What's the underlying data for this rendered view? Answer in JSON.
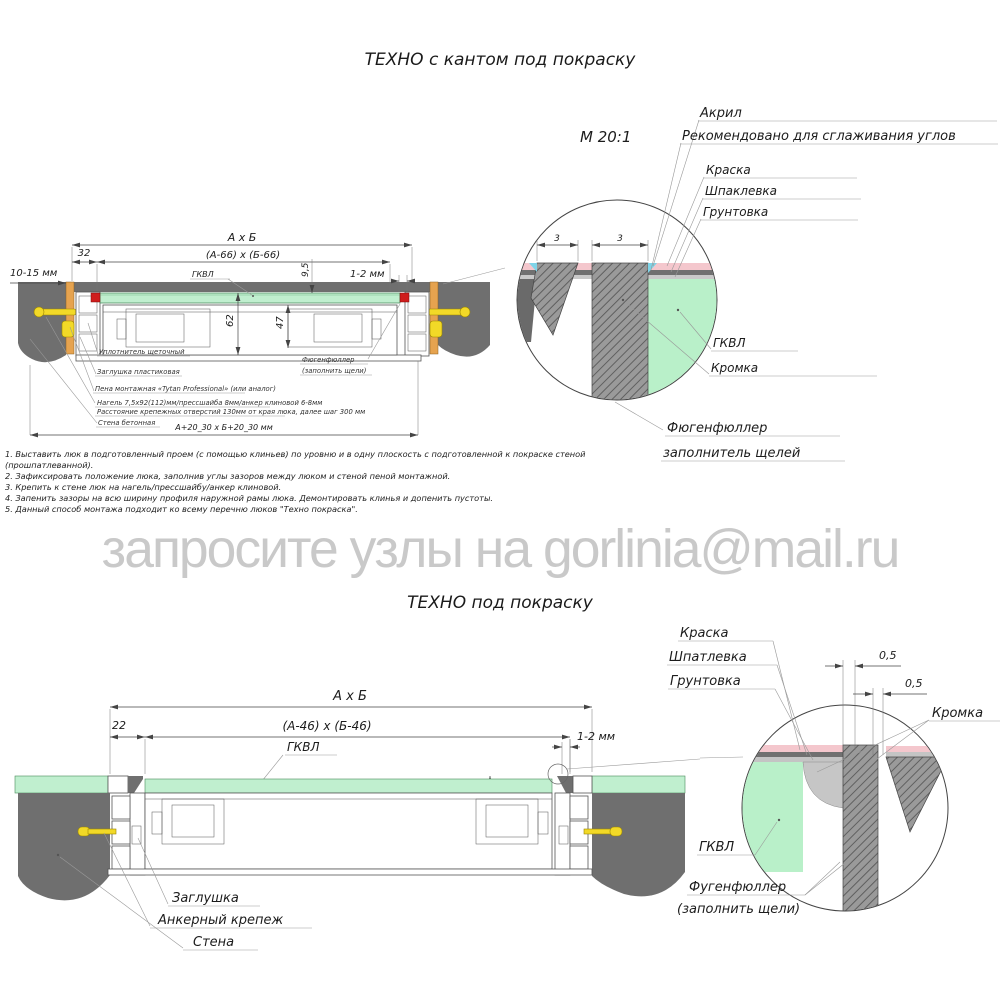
{
  "titles": {
    "top": "ТЕХНО с кантом под покраску",
    "bottom": "ТЕХНО под покраску"
  },
  "watermark": "запросите узлы на gorlinia@mail.ru",
  "notes": [
    "1. Выставить люк в подготовленный проем (с помощью клиньев) по уровню и в одну плоскость с подготовленной к покраске стеной (прошпатлеванной).",
    "2. Зафиксировать положение люка, заполнив углы зазоров между люком и стеной пеной монтажной.",
    "3. Крепить к стене люк на нагель/прессшайбу/анкер клиновой.",
    "4. Запенить зазоры на всю ширину профиля наружной рамы люка. Демонтировать клинья и допенить пустоты.",
    "5. Данный способ монтажа подходит ко всему перечню люков \"Техно покраска\"."
  ],
  "d1": {
    "dim_overall": "А х Б",
    "dim_inner": "(А-66) х (Б-66)",
    "dim_32": "32",
    "dim_gap_wall": "10-15 мм",
    "gkvl": "ГКВЛ",
    "dim_95": "9,5",
    "dim_12": "1-2 мм",
    "dim_62": "62",
    "dim_47": "47",
    "dim_opening": "А+20_30 х Б+20_30 мм",
    "lbl_seal": "Уплотнитель щеточный",
    "lbl_plug": "Заглушка пластиковая",
    "lbl_foam": "Пена монтажная «Tytan Professional» (или аналог)",
    "lbl_dowel": "Нагель 7,5х92(112)мм/прессшайба 8мм/анкер клиновой 6-8мм",
    "lbl_spacing": "Расстояние крепежных отверстий 130мм от края люка, далее шаг 300 мм",
    "lbl_wall": "Стена бетонная",
    "lbl_filler1": "Фюгенфюллер",
    "lbl_filler2": "(заполнить щели)"
  },
  "det1": {
    "scale": "М 20:1",
    "acryl": "Акрил",
    "acryl_note": "Рекомендовано для сглаживания углов",
    "paint": "Краска",
    "putty": "Шпаклевка",
    "primer": "Грунтовка",
    "gkvl": "ГКВЛ",
    "edge": "Кромка",
    "filler1": "Фюгенфюллер",
    "filler2": "заполнитель щелей",
    "dim3a": "3",
    "dim3b": "3"
  },
  "d2": {
    "dim_overall": "А х Б",
    "dim_inner": "(А-46) х (Б-46)",
    "dim_22": "22",
    "dim_12": "1-2 мм",
    "gkvl": "ГКВЛ",
    "dim_44": "44",
    "dim_62": "62",
    "lbl_plug": "Заглушка",
    "lbl_anchor": "Анкерный крепеж",
    "lbl_wall": "Стена"
  },
  "det2": {
    "paint": "Краска",
    "putty": "Шпатлевка",
    "primer": "Грунтовка",
    "dim05a": "0,5",
    "dim05b": "0,5",
    "edge": "Кромка",
    "gkvl": "ГКВЛ",
    "filler1": "Фугенфюллер",
    "filler2": "(заполнить щели)"
  },
  "colors": {
    "wall": "#6f6f6f",
    "green": "#c0efcf",
    "pink": "#f4c7cd",
    "blue": "#7fd4e8",
    "orange": "#e6a34f",
    "yellow": "#f2d927",
    "red": "#cf1d1d",
    "line": "#333333",
    "watermark": "#c9c9c9"
  }
}
